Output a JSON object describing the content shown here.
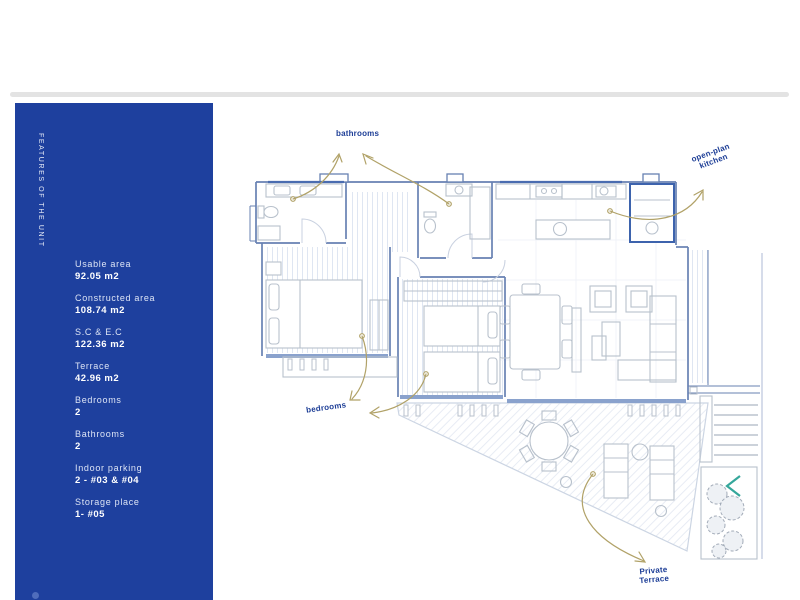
{
  "sidebar": {
    "vertical_title": "FEATURES OF THE UNIT",
    "features": [
      {
        "label": "Usable area",
        "value": "92.05 m2"
      },
      {
        "label": "Constructed area",
        "value": "108.74 m2"
      },
      {
        "label": "S.C & E.C",
        "value": "122.36 m2"
      },
      {
        "label": "Terrace",
        "value": "42.96 m2"
      },
      {
        "label": "Bedrooms",
        "value": "2"
      },
      {
        "label": "Bathrooms",
        "value": "2"
      },
      {
        "label": "Indoor parking",
        "value": "2 - #03 & #04"
      },
      {
        "label": "Storage place",
        "value": "1- #05"
      }
    ]
  },
  "plan": {
    "labels": {
      "bathrooms": "bathrooms",
      "kitchen_line1": "open-plan",
      "kitchen_line2": "kitchen",
      "bedrooms": "bedrooms",
      "terrace_line1": "Private",
      "terrace_line2": "Terrace"
    }
  },
  "colors": {
    "sidebar_bg": "#1e409e",
    "divider": "#e3e3e3",
    "wall": "#6781b2",
    "wall_dark": "#3d63ad",
    "furniture": "#b8c1cc",
    "window": "#8aa2cd",
    "arrow": "#b1a268",
    "label_text": "#1c3d96",
    "chevron": "#35a79b"
  }
}
